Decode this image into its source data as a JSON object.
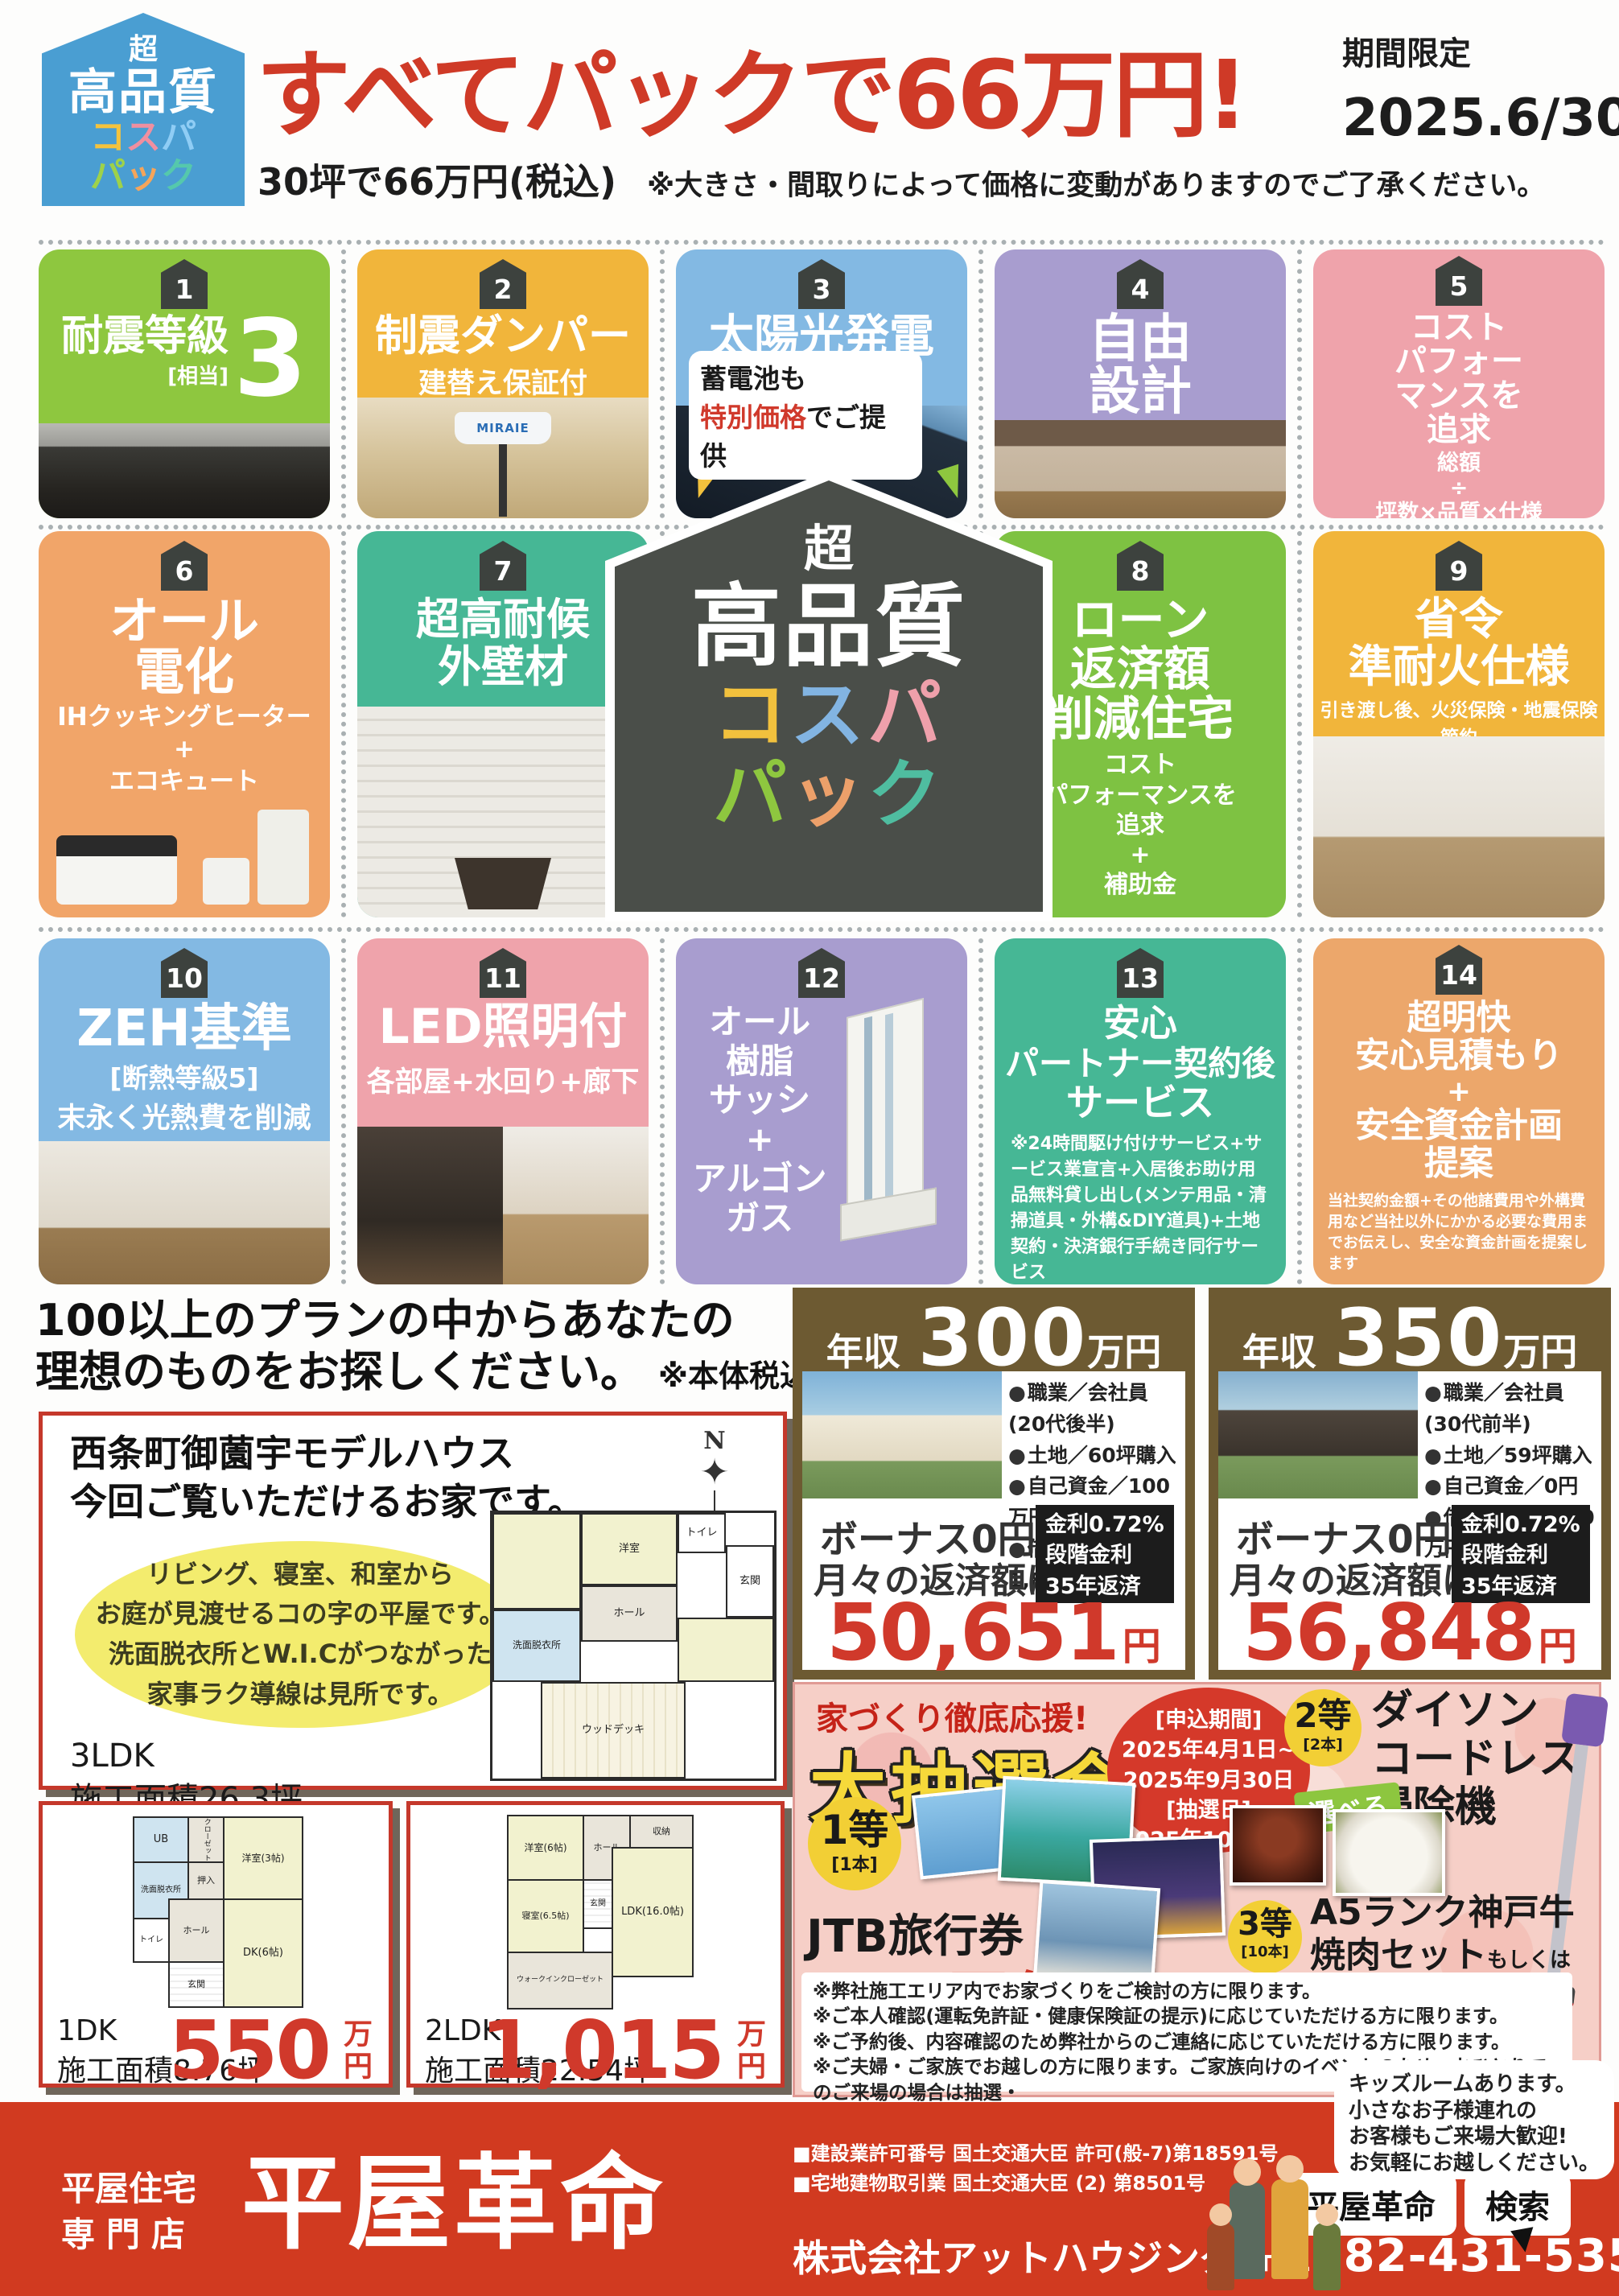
{
  "header": {
    "badge": {
      "cho": "超",
      "quality": "高品質",
      "color": "#4a9ed2",
      "kosupa": [
        {
          "ch": "コ",
          "color": "#f5c33d"
        },
        {
          "ch": "ス",
          "color": "#f08fa0"
        },
        {
          "ch": "パ",
          "color": "#8fcdf5"
        }
      ],
      "pack": [
        {
          "ch": "パ",
          "color": "#9ed24a"
        },
        {
          "ch": "ッ",
          "color": "#f5a55a"
        },
        {
          "ch": "ク",
          "color": "#55c8ac"
        }
      ]
    },
    "title": "すべてパックで66万円!",
    "title_color": "#cf3a27",
    "limited_label": "期間限定",
    "limited_date": "2025.6/30",
    "limited_day": "月",
    "limited_suffix": "まで",
    "subtitle": "30坪で66万円(税込)",
    "subtitle_note": "※大きさ・間取りによって価格に変動がありますのでご了承ください。"
  },
  "features": [
    {
      "num": "1",
      "color": "#8ec73f",
      "title": "耐震等級",
      "big": "3",
      "big_note": "[相当]"
    },
    {
      "num": "2",
      "color": "#f1b53b",
      "title": "制震ダンパー",
      "sub": "建替え保証付",
      "photo_label": "MIRAIE"
    },
    {
      "num": "3",
      "color": "#83b9e3",
      "title": "太陽光発電",
      "kw": "6.525kW",
      "pill_line1": "蓄電池も",
      "pill_accent": "特別価格",
      "pill_accent_color": "#d0392b",
      "pill_rest": "でご提供"
    },
    {
      "num": "4",
      "color": "#a89dcf",
      "title_lines": [
        "自由",
        "設計"
      ]
    },
    {
      "num": "5",
      "color": "#efa3ab",
      "title_lines": [
        "コスト",
        "パフォー",
        "マンスを",
        "追求"
      ],
      "sub_lines": [
        "総額",
        "÷",
        "坪数×品質×仕様"
      ]
    },
    {
      "num": "6",
      "color": "#f1a569",
      "title_lines": [
        "オール",
        "電化"
      ],
      "sub_lines": [
        "IHクッキングヒーター",
        "+",
        "エコキュート"
      ]
    },
    {
      "num": "7",
      "color": "#46b795",
      "title_lines": [
        "超高耐候",
        "外壁材"
      ]
    },
    {
      "num": "8",
      "color": "#7ec242",
      "title_lines": [
        "ローン",
        "返済額",
        "削減住宅"
      ],
      "sub_lines": [
        "コスト",
        "パフォーマンスを",
        "追求",
        "+",
        "補助金"
      ]
    },
    {
      "num": "9",
      "color": "#f1b53b",
      "title_lines": [
        "省令",
        "準耐火仕様"
      ],
      "sub": "引き渡し後、火災保険・地震保険節約"
    },
    {
      "num": "10",
      "color": "#83b9e3",
      "title": "ZEH基準",
      "sub_lines": [
        "[断熱等級5]",
        "末永く光熱費を削減"
      ]
    },
    {
      "num": "11",
      "color": "#efa3ab",
      "title": "LED照明付",
      "sub": "各部屋+水回り+廊下"
    },
    {
      "num": "12",
      "color": "#a89dcf",
      "title_lines": [
        "オール",
        "樹脂",
        "サッシ",
        "+",
        "アルゴン",
        "ガス"
      ]
    },
    {
      "num": "13",
      "color": "#46b795",
      "title_lines": [
        "安心",
        "パートナー契約後",
        "サービス"
      ],
      "note": "※24時間駆け付けサービス+サービス業宣言+入居後お助け用品無料貸し出し(メンテ用品・清掃道具・外構&DIY道具)+土地契約・決済銀行手続き同行サービス"
    },
    {
      "num": "14",
      "color": "#eca76b",
      "title_lines": [
        "超明快",
        "安心見積もり",
        "+",
        "安全資金計画",
        "提案"
      ],
      "note": "当社契約金額+その他諸費用や外構費用など当社以外にかかる必要な費用までお伝えし、安全な資金計画を提案します"
    }
  ],
  "center_logo": {
    "cho": "超",
    "quality": "高品質",
    "kosupa": [
      {
        "ch": "コ",
        "color": "#f2c13d"
      },
      {
        "ch": "ス",
        "color": "#82b4e2"
      },
      {
        "ch": "パ",
        "color": "#efa0ab"
      }
    ],
    "pack": [
      {
        "ch": "パ",
        "color": "#8ec73f"
      },
      {
        "ch": "ッ",
        "color": "#eca06a"
      },
      {
        "ch": "ク",
        "color": "#4fbda0"
      }
    ]
  },
  "plans_intro": {
    "line1": "100以上のプランの中からあなたの",
    "line2": "理想のものをお探しください。",
    "note": "※本体税込価格です"
  },
  "model_house": {
    "title1": "西条町御薗宇モデルハウス",
    "title2": "今回ご覧いただけるお家です。",
    "bubble_lines": [
      "リビング、寝室、和室から",
      "お庭が見渡せるコの字の平屋です。",
      "洗面脱衣所とW.I.Cがつながった",
      "家事ラク導線は見所です。"
    ],
    "type": "3LDK",
    "area": "施工面積26.3坪",
    "compass": "N",
    "rooms": [
      "洋室",
      "トイレ",
      "玄関",
      "ホール",
      "洗面脱衣所",
      "ウッドデッキ"
    ]
  },
  "income_cards": [
    {
      "label": "年収",
      "amount": "300",
      "unit": "万円",
      "details": [
        "職業／会社員(20代後半)",
        "土地／60坪購入",
        "自己資金／100万円",
        "借入金額／1,880万円"
      ],
      "bonus1": "ボーナス0円",
      "bonus2": "月々の返済額は",
      "rate_lines": [
        "金利0.72%",
        "段階金利",
        "35年返済"
      ],
      "payment": "50,651",
      "yen": "円"
    },
    {
      "label": "年収",
      "amount": "350",
      "unit": "万円",
      "details": [
        "職業／会社員(30代前半)",
        "土地／59坪購入",
        "自己資金／0円",
        "借入金額 2,110万円"
      ],
      "bonus1": "ボーナス0円",
      "bonus2": "月々の返済額は",
      "rate_lines": [
        "金利0.72%",
        "段階金利",
        "35年返済"
      ],
      "payment": "56,848",
      "yen": "円"
    }
  ],
  "lottery": {
    "support": "家づくり徹底応援!",
    "title": "大抽選会!",
    "schedule_lines": [
      "[申込期間]",
      "2025年4月1日~",
      "2025年9月30日",
      "[抽選日]",
      "2025年10月初旬"
    ],
    "first": {
      "rank": "1等",
      "count": "[1本]",
      "name": "JTB旅行券",
      "value": "10万円分"
    },
    "second": {
      "rank": "2等",
      "count": "[2本]",
      "name_lines": [
        "ダイソン",
        "コードレス",
        "掃除機"
      ]
    },
    "third": {
      "rank": "3等",
      "count": "[10本]",
      "line1": "A5ランク神戸牛",
      "line2": "焼肉セット",
      "line2_small": "もしくは",
      "line3": "新潟県産コシヒカリ",
      "line3_small": "10kg"
    },
    "choose": "選べる",
    "notes": [
      "※弊社施工エリア内でお家づくりをご検討の方に限ります。",
      "※ご本人確認(運転免許証・健康保険証の提示)に応じていただける方に限ります。",
      "※ご予約後、内容確認のため弊社からのご連絡に応じていただける方に限ります。",
      "※ご夫婦・ご家族でお越しの方に限ります。ご家族向けのイベントのため、おひとりでのご来場の場合は抽選・",
      "　プレゼントともに対象外となります。ご了承ください。",
      "※弊社モデルハウス・見学会にはじめてお越しの方で、ご来場アンケートにご協力のうえ全質問にご回答いただける方に限ります。"
    ]
  },
  "floor_plans": [
    {
      "type": "1DK",
      "area": "施工面積8.76坪",
      "price": "550",
      "unit": "万円",
      "rooms": [
        "UB",
        "クローゼット",
        "洋室(3帖)",
        "洗面脱衣所",
        "押入",
        "トイレ",
        "ホール",
        "DK(6帖)",
        "玄関"
      ]
    },
    {
      "type": "2LDK",
      "area": "施工面積22.54坪",
      "price": "1,015",
      "unit": "万円",
      "rooms": [
        "洋室(6帖)",
        "ホール",
        "収納",
        "LDK(16.0帖)",
        "玄関",
        "寝室(6.5帖)",
        "ウォークインクローゼット"
      ]
    }
  ],
  "footer": {
    "bg": "#d13a20",
    "shop_type1": "平屋住宅",
    "shop_type2": "専門店",
    "brand": "平屋革命",
    "license1": "■建設業許可番号 国土交通大臣 許可(般-7)第18591号",
    "license2": "■宅地建物取引業 国土交通大臣 (2) 第8501号",
    "company": "株式会社アットハウジング",
    "tel_label": "TEL.",
    "tel": "082-431-5355",
    "search_word": "平屋革命",
    "search_btn": "検索",
    "bubble_lines": [
      "キッズルームあります。",
      "小さなお子様連れの",
      "お客様もご来場大歓迎!",
      "お気軽にお越しください。"
    ]
  }
}
